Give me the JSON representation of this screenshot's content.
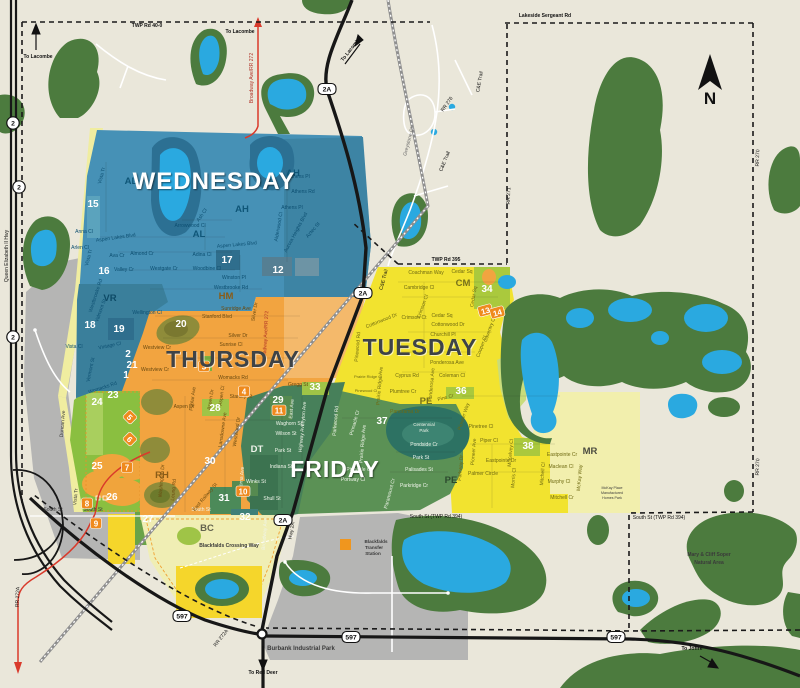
{
  "map_title": "Blackfalds residential collection day zones map",
  "colors": {
    "background": "#eae7da",
    "wednesday": "#4691b6",
    "thursday": "#f2a440",
    "tuesday": "#f2e32f",
    "friday": "#5b9155",
    "forest": "#4c7b3e",
    "water": "#2aa9e0",
    "badge_orange": "#ef8a1d",
    "highway_red": "#d93a2b",
    "text": {
      "w": "#0d4f71",
      "t": "#6b4a10",
      "u": "#6f6a12",
      "f": "#f0f5ea",
      "d": "#3a3a3a",
      "k": "#111111",
      "g": "#666666",
      "r": "#b03226"
    }
  },
  "days": [
    {
      "t": "WEDNESDAY",
      "x": 214,
      "y": 189,
      "s": 24,
      "fill": "#ffffff",
      "sh": "d"
    },
    {
      "t": "THURSDAY",
      "x": 233,
      "y": 367,
      "s": 23,
      "fill": "#3e4347",
      "sh": "l"
    },
    {
      "t": "TUESDAY",
      "x": 420,
      "y": 355,
      "s": 23,
      "fill": "#3e4347",
      "sh": "l"
    },
    {
      "t": "FRIDAY",
      "x": 335,
      "y": 477,
      "s": 23,
      "fill": "#ffffff",
      "sh": "d"
    }
  ],
  "neighborhoods": [
    {
      "t": "AL",
      "x": 131,
      "y": 184,
      "fill": "#0f5678"
    },
    {
      "t": "AL",
      "x": 199,
      "y": 237,
      "fill": "#0f5678"
    },
    {
      "t": "AH",
      "x": 293,
      "y": 176,
      "fill": "#0f5678"
    },
    {
      "t": "AH",
      "x": 242,
      "y": 212,
      "fill": "#0f5678"
    },
    {
      "t": "VR",
      "x": 110,
      "y": 301,
      "fill": "#0d4a66"
    },
    {
      "t": "HM",
      "x": 226,
      "y": 299,
      "fill": "#8a5c17"
    },
    {
      "t": "RH",
      "x": 162,
      "y": 478,
      "fill": "#8a5c17"
    },
    {
      "t": "DT",
      "x": 257,
      "y": 452,
      "fill": "#eef3ea"
    },
    {
      "t": "BC",
      "x": 207,
      "y": 531,
      "fill": "#63634e"
    },
    {
      "t": "CM",
      "x": 463,
      "y": 286,
      "fill": "#77711a"
    },
    {
      "t": "PE",
      "x": 426,
      "y": 404,
      "fill": "#77711a"
    },
    {
      "t": "PE",
      "x": 451,
      "y": 483,
      "fill": "#2c4a2e"
    },
    {
      "t": "MR",
      "x": 590,
      "y": 454,
      "fill": "#4c4c40"
    }
  ],
  "zones_plain": [
    {
      "n": "1",
      "x": 126,
      "y": 378
    },
    {
      "n": "2",
      "x": 128,
      "y": 357
    },
    {
      "n": "12",
      "x": 278,
      "y": 273
    },
    {
      "n": "15",
      "x": 93,
      "y": 207
    },
    {
      "n": "16",
      "x": 104,
      "y": 274
    },
    {
      "n": "17",
      "x": 227,
      "y": 263
    },
    {
      "n": "18",
      "x": 90,
      "y": 328
    },
    {
      "n": "19",
      "x": 119,
      "y": 332
    },
    {
      "n": "20",
      "x": 181,
      "y": 327
    },
    {
      "n": "21",
      "x": 132,
      "y": 368
    },
    {
      "n": "23",
      "x": 113,
      "y": 398
    },
    {
      "n": "24",
      "x": 97,
      "y": 405
    },
    {
      "n": "25",
      "x": 97,
      "y": 469
    },
    {
      "n": "26",
      "x": 112,
      "y": 500
    },
    {
      "n": "27",
      "x": 148,
      "y": 522
    },
    {
      "n": "28",
      "x": 215,
      "y": 411
    },
    {
      "n": "29",
      "x": 278,
      "y": 403
    },
    {
      "n": "30",
      "x": 210,
      "y": 464
    },
    {
      "n": "31",
      "x": 224,
      "y": 501
    },
    {
      "n": "32",
      "x": 245,
      "y": 520
    },
    {
      "n": "33",
      "x": 315,
      "y": 390
    },
    {
      "n": "34",
      "x": 487,
      "y": 292
    },
    {
      "n": "36",
      "x": 461,
      "y": 394
    },
    {
      "n": "37",
      "x": 382,
      "y": 424
    },
    {
      "n": "38",
      "x": 528,
      "y": 449
    }
  ],
  "zones_badges": [
    {
      "n": "3",
      "x": 204,
      "y": 369
    },
    {
      "n": "4",
      "x": 244,
      "y": 394
    },
    {
      "n": "5",
      "x": 128,
      "y": 419,
      "r": 45
    },
    {
      "n": "6",
      "x": 128,
      "y": 441,
      "r": 45
    },
    {
      "n": "7",
      "x": 127,
      "y": 470
    },
    {
      "n": "8",
      "x": 87,
      "y": 506
    },
    {
      "n": "9",
      "x": 96,
      "y": 526
    },
    {
      "n": "10",
      "x": 243,
      "y": 494
    },
    {
      "n": "11",
      "x": 279,
      "y": 413
    },
    {
      "n": "13",
      "x": 486,
      "y": 313,
      "r": -15
    },
    {
      "n": "14",
      "x": 498,
      "y": 315,
      "r": -15
    }
  ],
  "shields": [
    {
      "t": "2",
      "x": 13,
      "y": 123,
      "k": "c"
    },
    {
      "t": "2",
      "x": 19,
      "y": 187,
      "k": "c"
    },
    {
      "t": "2",
      "x": 13,
      "y": 337,
      "k": "c"
    },
    {
      "t": "2A",
      "x": 327,
      "y": 89,
      "k": "r"
    },
    {
      "t": "2A",
      "x": 363,
      "y": 293,
      "k": "r"
    },
    {
      "t": "2A",
      "x": 283,
      "y": 520,
      "k": "r"
    },
    {
      "t": "597",
      "x": 182,
      "y": 616,
      "k": "r"
    },
    {
      "t": "597",
      "x": 351,
      "y": 637,
      "k": "r"
    },
    {
      "t": "597",
      "x": 616,
      "y": 637,
      "k": "r"
    }
  ],
  "compass": {
    "label": "N",
    "x": 710,
    "y": 104
  },
  "labels": [
    {
      "t": "TWP Rd 40-0",
      "x": 147,
      "y": 27,
      "c": "k",
      "b": 1
    },
    {
      "t": "Lakeside Sergeant Rd",
      "x": 545,
      "y": 17,
      "c": "k",
      "b": 1
    },
    {
      "t": "TWP Rd 395",
      "x": 446,
      "y": 261,
      "c": "k",
      "b": 1
    },
    {
      "t": "RR 271",
      "x": 510,
      "y": 196,
      "r": -88,
      "c": "k"
    },
    {
      "t": "RR 270",
      "x": 759,
      "y": 158,
      "r": -88,
      "c": "k"
    },
    {
      "t": "RR 270",
      "x": 759,
      "y": 467,
      "r": -88,
      "c": "k"
    },
    {
      "t": "RR 276",
      "x": 448,
      "y": 105,
      "r": -55,
      "c": "k"
    },
    {
      "t": "RR 272A",
      "x": 19,
      "y": 597,
      "r": -88,
      "c": "k"
    },
    {
      "t": "RR 272A",
      "x": 222,
      "y": 639,
      "r": -52,
      "c": "k"
    },
    {
      "t": "Queen Elizabeth II Hwy",
      "x": 8,
      "y": 256,
      "r": -90,
      "c": "k"
    },
    {
      "t": "Broadway Ave/RR 272",
      "x": 253,
      "y": 78,
      "r": -90,
      "c": "r"
    },
    {
      "t": "Broadway Ave/RR 272",
      "x": 267,
      "y": 336,
      "r": -87,
      "c": "r"
    },
    {
      "t": "C&E Trail",
      "x": 481,
      "y": 82,
      "r": -80,
      "c": "k"
    },
    {
      "t": "C&E Trail",
      "x": 446,
      "y": 162,
      "r": -68,
      "c": "k"
    },
    {
      "t": "C&E Trail",
      "x": 385,
      "y": 280,
      "r": -75,
      "c": "k"
    },
    {
      "t": "Greystone Cl",
      "x": 410,
      "y": 142,
      "r": -75,
      "c": "g"
    },
    {
      "t": "South St",
      "x": 53,
      "y": 511,
      "c": "d"
    },
    {
      "t": "South St",
      "x": 93,
      "y": 511,
      "c": "d"
    },
    {
      "t": "South St",
      "x": 201,
      "y": 511,
      "c": "f"
    },
    {
      "t": "South St (TWP Rd 394)",
      "x": 436,
      "y": 518,
      "c": "k"
    },
    {
      "t": "South St (TWP Rd 394)",
      "x": 659,
      "y": 519,
      "c": "k"
    },
    {
      "t": "Hwy 2A",
      "x": 293,
      "y": 531,
      "r": -80,
      "c": "k"
    },
    {
      "t": "Broadway Ave",
      "x": 266,
      "y": 534,
      "r": -86,
      "c": "f"
    },
    {
      "t": "East Railway St",
      "x": 206,
      "y": 498,
      "r": -50,
      "c": "t"
    },
    {
      "t": "Duncan Ave",
      "x": 64,
      "y": 424,
      "r": -85,
      "c": "d"
    },
    {
      "t": "Vista Tr",
      "x": 77,
      "y": 497,
      "r": -85,
      "c": "d"
    },
    {
      "t": "Blackfalds Crossing Way",
      "x": 229,
      "y": 547,
      "c": "d",
      "b": 1
    },
    {
      "t": "Burbank Industrial Park",
      "x": 301,
      "y": 650,
      "c": "d",
      "b": 1,
      "s": 6
    },
    {
      "t": "Mary & Cliff Soper",
      "x": 709,
      "y": 556,
      "c": "d",
      "b": 1
    },
    {
      "t": "Natural Area",
      "x": 709,
      "y": 564,
      "c": "d",
      "b": 1
    },
    {
      "t": "Centennial",
      "x": 424,
      "y": 426,
      "c": "f",
      "s": 4.5
    },
    {
      "t": "Park",
      "x": 424,
      "y": 432,
      "c": "f",
      "s": 4.5
    },
    {
      "t": "McKay Place",
      "x": 612,
      "y": 489,
      "c": "d",
      "s": 3.6
    },
    {
      "t": "Manufactured",
      "x": 612,
      "y": 494,
      "c": "d",
      "s": 3.6
    },
    {
      "t": "Homes Park",
      "x": 612,
      "y": 499,
      "c": "d",
      "s": 3.6
    },
    {
      "t": "Blackfalds",
      "x": 376,
      "y": 543,
      "c": "d",
      "s": 4.6,
      "b": 1
    },
    {
      "t": "Transfer",
      "x": 374,
      "y": 549,
      "c": "d",
      "s": 4.6,
      "b": 1
    },
    {
      "t": "Station",
      "x": 373,
      "y": 555,
      "c": "d",
      "s": 4.6,
      "b": 1
    },
    {
      "t": "To Lacombe",
      "x": 38,
      "y": 58,
      "c": "k",
      "b": 1
    },
    {
      "t": "To Lacombe",
      "x": 240,
      "y": 33,
      "c": "k",
      "b": 1
    },
    {
      "t": "To Lacombe",
      "x": 352,
      "y": 50,
      "r": -52,
      "c": "k",
      "b": 1
    },
    {
      "t": "To Red Deer",
      "x": 263,
      "y": 674,
      "c": "k",
      "b": 1
    },
    {
      "t": "To Joffre",
      "x": 692,
      "y": 650,
      "c": "k",
      "b": 1
    },
    {
      "t": "Vista Tr",
      "x": 103,
      "y": 176,
      "r": -75,
      "c": "w"
    },
    {
      "t": "Vista Tr",
      "x": 90,
      "y": 258,
      "r": -75,
      "c": "w"
    },
    {
      "t": "Anna Cl",
      "x": 84,
      "y": 233,
      "c": "w"
    },
    {
      "t": "Aspen Lakes Blvd",
      "x": 116,
      "y": 239,
      "r": -8,
      "c": "w"
    },
    {
      "t": "Aspen Lakes Blvd",
      "x": 237,
      "y": 246,
      "r": -5,
      "c": "w"
    },
    {
      "t": "Arlen Cl",
      "x": 80,
      "y": 249,
      "c": "w"
    },
    {
      "t": "Ava Cr",
      "x": 117,
      "y": 257,
      "c": "w"
    },
    {
      "t": "Valley Cr",
      "x": 124,
      "y": 271,
      "c": "w"
    },
    {
      "t": "Almond Cr",
      "x": 142,
      "y": 255,
      "c": "w"
    },
    {
      "t": "Westgate Cr",
      "x": 164,
      "y": 270,
      "c": "w"
    },
    {
      "t": "Adina Cl",
      "x": 202,
      "y": 256,
      "c": "w"
    },
    {
      "t": "Woodbine Cl",
      "x": 207,
      "y": 270,
      "c": "w"
    },
    {
      "t": "Winston Pl",
      "x": 234,
      "y": 279,
      "c": "w"
    },
    {
      "t": "Westbrooke Rd",
      "x": 231,
      "y": 289,
      "c": "w"
    },
    {
      "t": "Westbrooke Rd",
      "x": 97,
      "y": 296,
      "r": -72,
      "c": "w"
    },
    {
      "t": "Arrowwood Cl",
      "x": 190,
      "y": 227,
      "c": "w"
    },
    {
      "t": "Ash Cl",
      "x": 203,
      "y": 216,
      "r": -55,
      "c": "w"
    },
    {
      "t": "Athens Pl",
      "x": 299,
      "y": 178,
      "c": "w"
    },
    {
      "t": "Athens Rd",
      "x": 303,
      "y": 193,
      "c": "w"
    },
    {
      "t": "Athens Pl",
      "x": 292,
      "y": 209,
      "c": "w"
    },
    {
      "t": "Aurora Heights Blvd",
      "x": 297,
      "y": 233,
      "r": -62,
      "c": "w"
    },
    {
      "t": "Alderwood Cl",
      "x": 280,
      "y": 227,
      "r": -80,
      "c": "w"
    },
    {
      "t": "Aztec St",
      "x": 314,
      "y": 231,
      "r": -50,
      "c": "w"
    },
    {
      "t": "Valmont St",
      "x": 102,
      "y": 311,
      "r": -70,
      "c": "w"
    },
    {
      "t": "Vermont St",
      "x": 92,
      "y": 370,
      "r": -78,
      "c": "w"
    },
    {
      "t": "Vintage Cl",
      "x": 110,
      "y": 347,
      "r": -12,
      "c": "w"
    },
    {
      "t": "Vista Cl",
      "x": 74,
      "y": 348,
      "c": "w"
    },
    {
      "t": "Wellington Cl",
      "x": 147,
      "y": 314,
      "c": "w"
    },
    {
      "t": "Womacks Rd",
      "x": 103,
      "y": 389,
      "r": -18,
      "c": "w"
    },
    {
      "t": "Womacks Rd",
      "x": 233,
      "y": 379,
      "c": "t"
    },
    {
      "t": "Westview Cr",
      "x": 157,
      "y": 349,
      "c": "t"
    },
    {
      "t": "Westview Cr",
      "x": 155,
      "y": 371,
      "c": "t"
    },
    {
      "t": "Sunridge Ave",
      "x": 236,
      "y": 310,
      "c": "t"
    },
    {
      "t": "Stanford Blvd",
      "x": 217,
      "y": 318,
      "c": "t"
    },
    {
      "t": "Silver Dr",
      "x": 238,
      "y": 337,
      "c": "t"
    },
    {
      "t": "Silver Dr",
      "x": 256,
      "y": 312,
      "r": -80,
      "c": "t"
    },
    {
      "t": "Sunrise Cl",
      "x": 231,
      "y": 346,
      "c": "t"
    },
    {
      "t": "Aspen Dr",
      "x": 184,
      "y": 408,
      "c": "t"
    },
    {
      "t": "Aspen Dr",
      "x": 212,
      "y": 400,
      "r": -80,
      "c": "t"
    },
    {
      "t": "Poplar Ave",
      "x": 194,
      "y": 399,
      "r": -82,
      "c": "t"
    },
    {
      "t": "Aspen Cl",
      "x": 223,
      "y": 396,
      "r": -82,
      "c": "t"
    },
    {
      "t": "Stanley St",
      "x": 241,
      "y": 398,
      "c": "t"
    },
    {
      "t": "Lansdowne Ave",
      "x": 224,
      "y": 430,
      "r": -82,
      "c": "t"
    },
    {
      "t": "Westwood Dr",
      "x": 238,
      "y": 432,
      "r": -82,
      "c": "t"
    },
    {
      "t": "Leung Rd",
      "x": 175,
      "y": 490,
      "r": -85,
      "c": "t"
    },
    {
      "t": "Washington Dr",
      "x": 163,
      "y": 481,
      "r": -85,
      "c": "t"
    },
    {
      "t": "Gregg St",
      "x": 298,
      "y": 386,
      "c": "t"
    },
    {
      "t": "Coachman Way",
      "x": 426,
      "y": 274,
      "c": "u"
    },
    {
      "t": "Cedar Sq",
      "x": 462,
      "y": 273,
      "c": "u"
    },
    {
      "t": "Cedar Sq",
      "x": 442,
      "y": 317,
      "c": "u"
    },
    {
      "t": "Cedar Sq",
      "x": 475,
      "y": 297,
      "r": -80,
      "c": "u"
    },
    {
      "t": "Cambridge Cl",
      "x": 419,
      "y": 289,
      "c": "u"
    },
    {
      "t": "Crimson Cl",
      "x": 424,
      "y": 307,
      "r": -70,
      "c": "u"
    },
    {
      "t": "Crimson Ct",
      "x": 414,
      "y": 319,
      "c": "u"
    },
    {
      "t": "Cottonwood Dr",
      "x": 448,
      "y": 326,
      "c": "u"
    },
    {
      "t": "Cottonwood Dr",
      "x": 382,
      "y": 322,
      "r": -22,
      "c": "u"
    },
    {
      "t": "Churchill Pl",
      "x": 443,
      "y": 336,
      "c": "u"
    },
    {
      "t": "Coventry Cl",
      "x": 491,
      "y": 330,
      "r": -70,
      "c": "u"
    },
    {
      "t": "Cooper Cl",
      "x": 483,
      "y": 347,
      "r": -70,
      "c": "u"
    },
    {
      "t": "Ponderosa Ave",
      "x": 447,
      "y": 364,
      "c": "u"
    },
    {
      "t": "Ponderosa Ave",
      "x": 433,
      "y": 385,
      "r": -85,
      "c": "u"
    },
    {
      "t": "Cyprus Rd",
      "x": 407,
      "y": 377,
      "c": "u"
    },
    {
      "t": "Coleman Cl",
      "x": 452,
      "y": 377,
      "c": "u"
    },
    {
      "t": "Plumtree Cr",
      "x": 403,
      "y": 393,
      "c": "u"
    },
    {
      "t": "Prairie Ridge Ave",
      "x": 381,
      "y": 386,
      "r": -85,
      "c": "u"
    },
    {
      "t": "Prairie Ridge Cl",
      "x": 368,
      "y": 378,
      "c": "u",
      "s": 4
    },
    {
      "t": "Pinewood Rd",
      "x": 359,
      "y": 347,
      "r": -85,
      "c": "u"
    },
    {
      "t": "Pinewood Cl",
      "x": 366,
      "y": 392,
      "c": "u",
      "s": 4
    },
    {
      "t": "Pine Cr",
      "x": 446,
      "y": 399,
      "r": -15,
      "c": "u"
    },
    {
      "t": "Panorama Dr",
      "x": 405,
      "y": 413,
      "c": "u"
    },
    {
      "t": "Pioneer Way",
      "x": 465,
      "y": 417,
      "r": -72,
      "c": "u"
    },
    {
      "t": "Pinetree Cl",
      "x": 481,
      "y": 428,
      "c": "u"
    },
    {
      "t": "Piper Cl",
      "x": 489,
      "y": 442,
      "c": "u"
    },
    {
      "t": "Pioneer Ave",
      "x": 475,
      "y": 452,
      "r": -85,
      "c": "u"
    },
    {
      "t": "Parkway Dr",
      "x": 462,
      "y": 468,
      "r": -85,
      "c": "u"
    },
    {
      "t": "McKelvey Cl",
      "x": 512,
      "y": 453,
      "r": -85,
      "c": "u"
    },
    {
      "t": "Eastpointe Dr",
      "x": 501,
      "y": 462,
      "c": "u"
    },
    {
      "t": "Eastpointe Cr",
      "x": 562,
      "y": 456,
      "c": "u"
    },
    {
      "t": "Palmer Circle",
      "x": 483,
      "y": 475,
      "c": "u"
    },
    {
      "t": "Morris Cl",
      "x": 515,
      "y": 478,
      "r": -85,
      "c": "u"
    },
    {
      "t": "Maclean Cl",
      "x": 561,
      "y": 468,
      "c": "u"
    },
    {
      "t": "Murphy Cl",
      "x": 559,
      "y": 483,
      "c": "u"
    },
    {
      "t": "Mitchell Cl",
      "x": 544,
      "y": 474,
      "r": -85,
      "c": "u"
    },
    {
      "t": "Mitchell Cr",
      "x": 562,
      "y": 499,
      "c": "u"
    },
    {
      "t": "McKay Way",
      "x": 581,
      "y": 478,
      "r": -85,
      "c": "u"
    },
    {
      "t": "Pondside Cr",
      "x": 424,
      "y": 446,
      "c": "f"
    },
    {
      "t": "Park St",
      "x": 421,
      "y": 459,
      "c": "f"
    },
    {
      "t": "Palisades St",
      "x": 419,
      "y": 471,
      "c": "f"
    },
    {
      "t": "Parkridge Cr",
      "x": 414,
      "y": 487,
      "c": "f"
    },
    {
      "t": "Paramount Cr",
      "x": 391,
      "y": 494,
      "r": -75,
      "c": "f"
    },
    {
      "t": "Pinnacle Cl",
      "x": 359,
      "y": 471,
      "c": "f"
    },
    {
      "t": "Portway Cl",
      "x": 353,
      "y": 481,
      "c": "f"
    },
    {
      "t": "Pinnacle Cr",
      "x": 356,
      "y": 423,
      "r": -75,
      "c": "f"
    },
    {
      "t": "Prairie Ridge Ave",
      "x": 364,
      "y": 444,
      "r": -85,
      "c": "f"
    },
    {
      "t": "Parkwood Rd",
      "x": 337,
      "y": 421,
      "r": -85,
      "c": "f"
    },
    {
      "t": "Waghorn St",
      "x": 289,
      "y": 425,
      "c": "f"
    },
    {
      "t": "Wilson St",
      "x": 286,
      "y": 435,
      "c": "f"
    },
    {
      "t": "Park St",
      "x": 283,
      "y": 452,
      "c": "f"
    },
    {
      "t": "Indiana St",
      "x": 281,
      "y": 468,
      "c": "f"
    },
    {
      "t": "Winks St",
      "x": 256,
      "y": 483,
      "c": "f"
    },
    {
      "t": "Shull St",
      "x": 272,
      "y": 500,
      "c": "f"
    },
    {
      "t": "East Ave",
      "x": 293,
      "y": 409,
      "r": -85,
      "c": "f"
    },
    {
      "t": "Leyton Ave",
      "x": 305,
      "y": 414,
      "r": -85,
      "c": "f"
    },
    {
      "t": "Highway Ave",
      "x": 303,
      "y": 438,
      "r": -85,
      "c": "f"
    },
    {
      "t": "Lorna Ave",
      "x": 243,
      "y": 478,
      "r": -85,
      "c": "f"
    }
  ]
}
